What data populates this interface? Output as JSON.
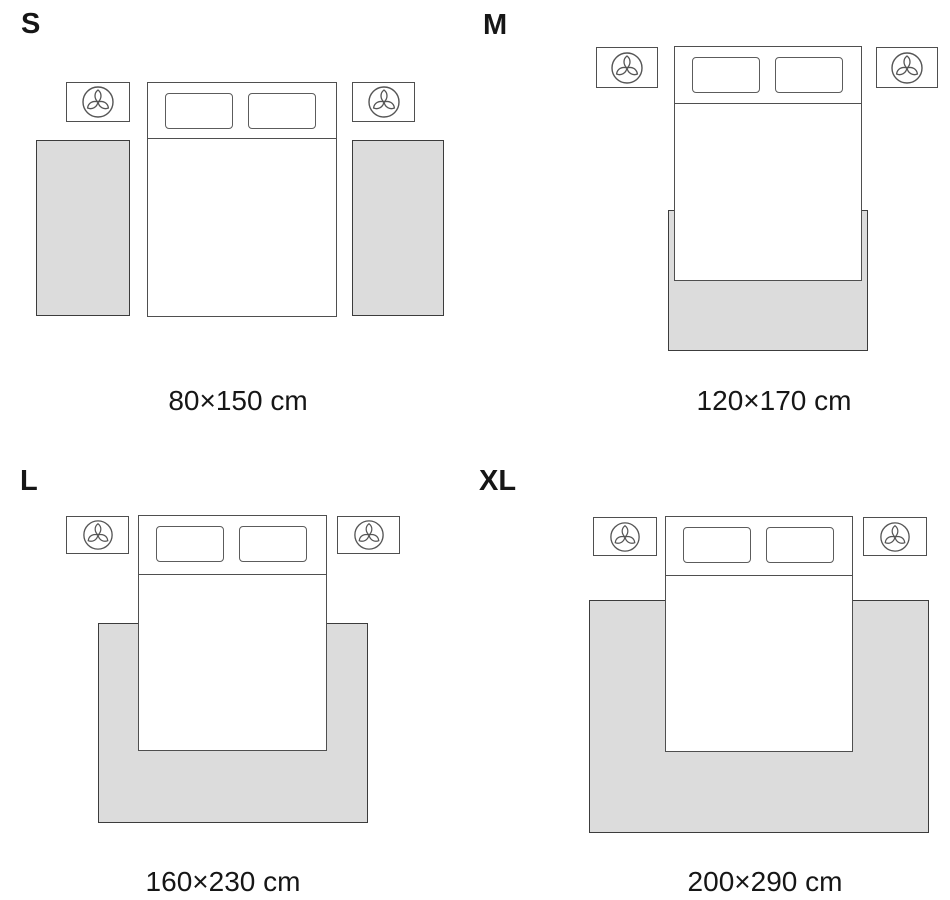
{
  "colors": {
    "background": "#ffffff",
    "rug_fill": "#dcdcdc",
    "rug_border": "#3c3c3c",
    "furniture_line": "#4f4f4f",
    "text": "#161616"
  },
  "sections": [
    {
      "id": "s",
      "label": "S",
      "size": "80×150 cm",
      "rug_count": 2
    },
    {
      "id": "m",
      "label": "M",
      "size": "120×170 cm",
      "rug_count": 1
    },
    {
      "id": "l",
      "label": "L",
      "size": "160×230 cm",
      "rug_count": 1
    },
    {
      "id": "xl",
      "label": "XL",
      "size": "200×290 cm",
      "rug_count": 1
    }
  ]
}
